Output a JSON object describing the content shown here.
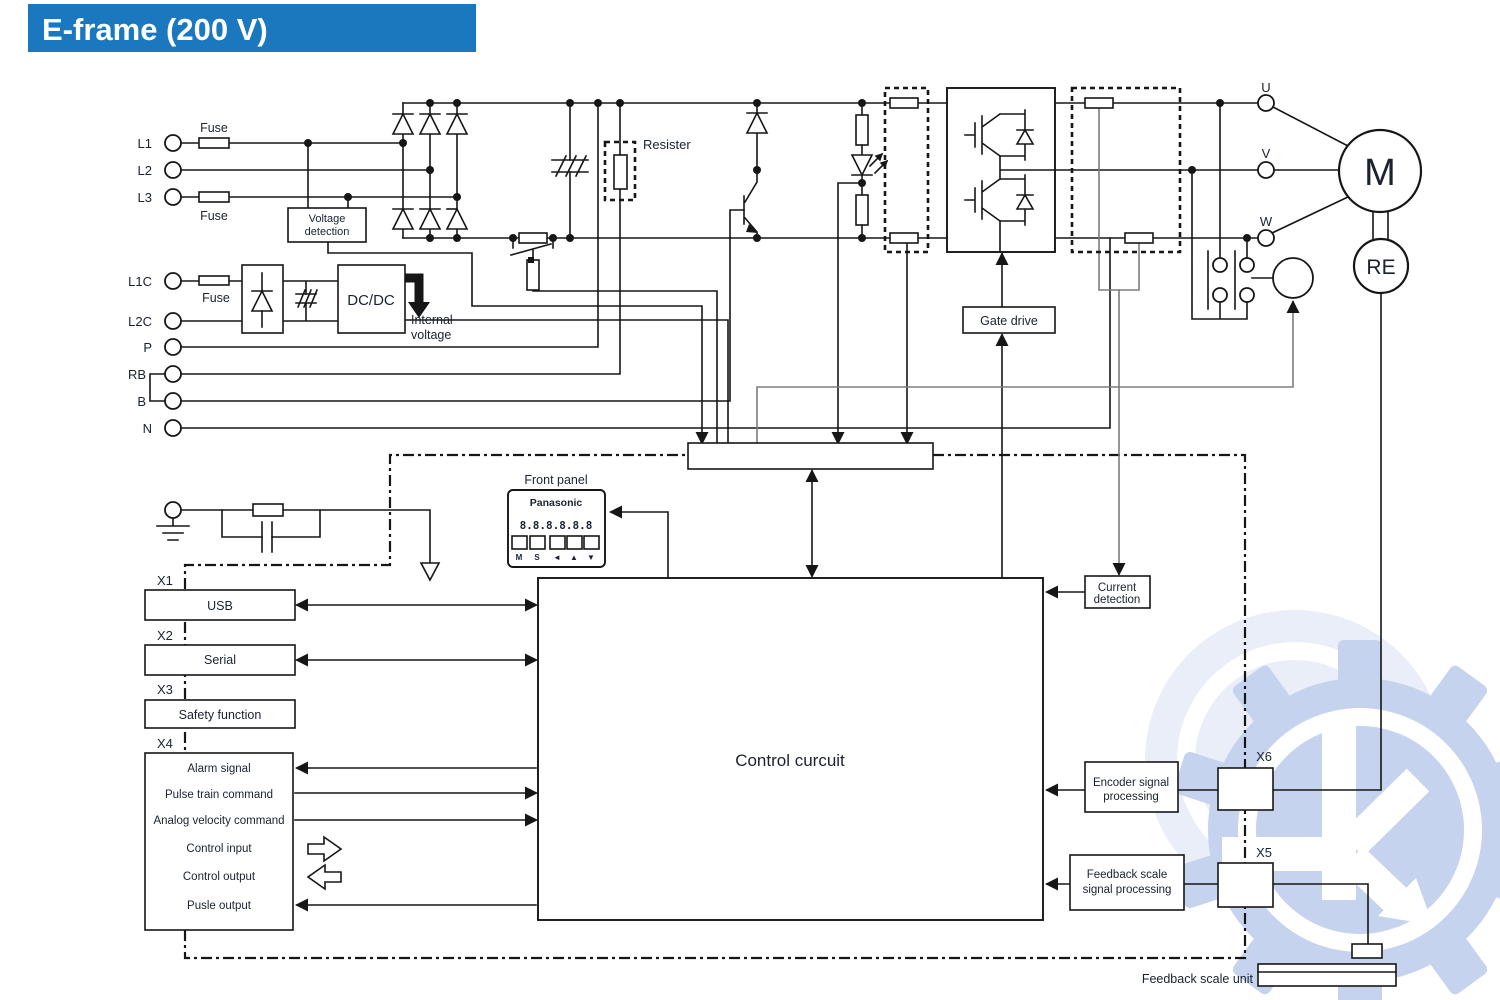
{
  "title": "E-frame (200 V)",
  "colors": {
    "banner": "#1b78be",
    "line": "#161616",
    "grey_line": "#7d7d7d",
    "text": "#1a2230",
    "watermark": "#c5d3ee",
    "watermark_light": "#e9eef8"
  },
  "terminals": {
    "l1": "L1",
    "l2": "L2",
    "l3": "L3",
    "l1c": "L1C",
    "l2c": "L2C",
    "p": "P",
    "rb": "RB",
    "b": "B",
    "n": "N"
  },
  "phase_terminals": {
    "u": "U",
    "v": "V",
    "w": "W"
  },
  "labels": {
    "fuse": "Fuse",
    "voltage_detection_line1": "Voltage",
    "voltage_detection_line2": "detection",
    "resister": "Resister",
    "dcdc": "DC/DC",
    "internal_voltage_line1": "Internal",
    "internal_voltage_line2": "voltage",
    "gate_drive": "Gate drive",
    "front_panel": "Front panel",
    "control_circuit": "Control curcuit",
    "current_detection_line1": "Current",
    "current_detection_line2": "detection",
    "encoder_processing_line1": "Encoder signal",
    "encoder_processing_line2": "processing",
    "feedback_processing_line1": "Feedback scale",
    "feedback_processing_line2": "signal processing",
    "feedback_scale_unit": "Feedback scale unit"
  },
  "motor": {
    "motor": "M",
    "encoder": "RE"
  },
  "front_panel": {
    "brand": "Panasonic",
    "display": "8.8.8.8.8.8",
    "buttons": [
      "M",
      "S",
      "◄",
      "▲",
      "▼"
    ]
  },
  "connectors": {
    "x1": "X1",
    "x2": "X2",
    "x3": "X3",
    "x4": "X4",
    "x5": "X5",
    "x6": "X6"
  },
  "io": {
    "usb": "USB",
    "serial": "Serial",
    "safety": "Safety function",
    "x4_rows": [
      "Alarm signal",
      "Pulse train command",
      "Analog velocity command",
      "Control input",
      "Control output",
      "Pusle output"
    ]
  }
}
